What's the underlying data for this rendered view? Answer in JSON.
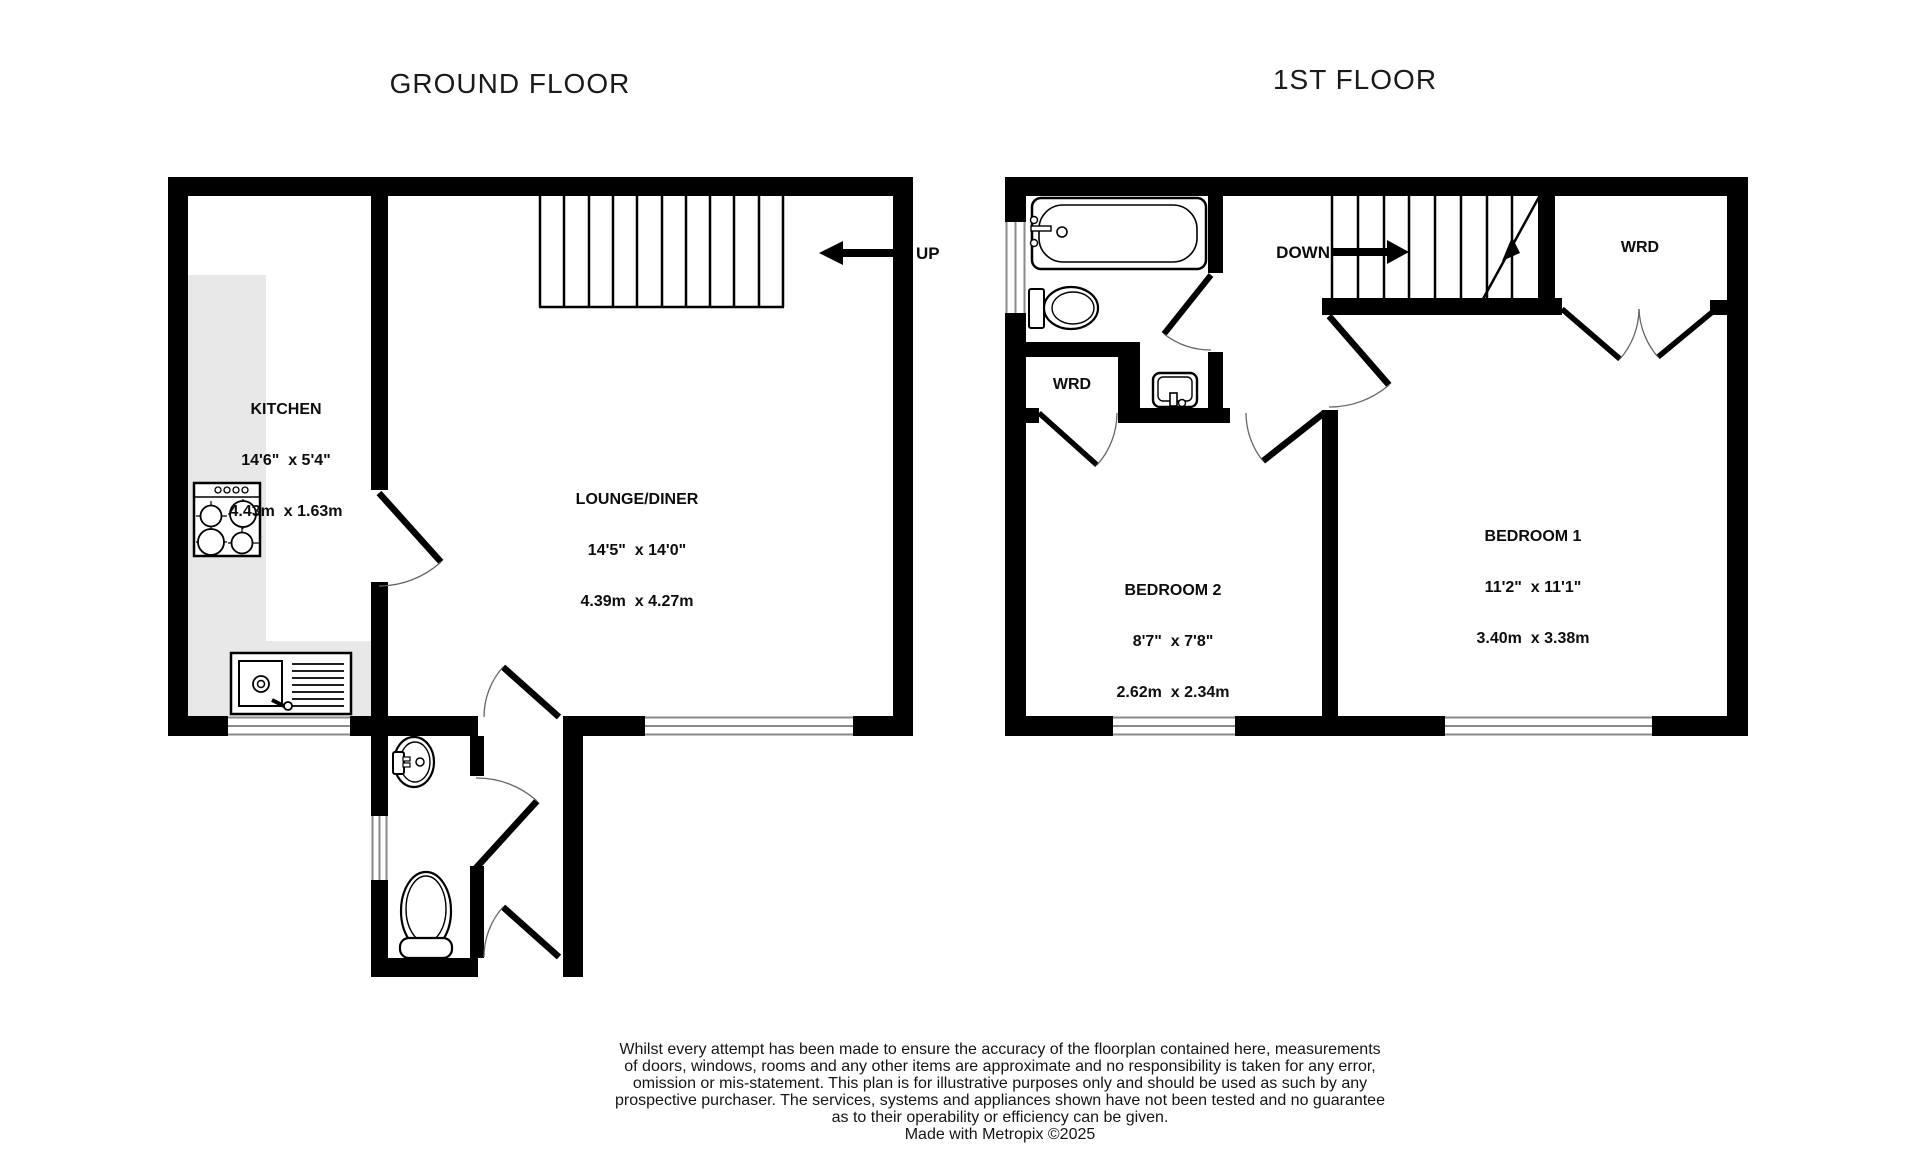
{
  "titles": {
    "ground_floor": "GROUND FLOOR",
    "first_floor": "1ST FLOOR"
  },
  "ground_floor": {
    "kitchen": {
      "label": "KITCHEN",
      "imperial": "14'6\"  x 5'4\"",
      "metric": "4.43m  x 1.63m"
    },
    "lounge": {
      "label": "LOUNGE/DINER",
      "imperial": "14'5\"  x 14'0\"",
      "metric": "4.39m  x 4.27m"
    },
    "stair_label": "UP"
  },
  "first_floor": {
    "bedroom1": {
      "label": "BEDROOM 1",
      "imperial": "11'2\"  x 11'1\"",
      "metric": "3.40m  x 3.38m"
    },
    "bedroom2": {
      "label": "BEDROOM 2",
      "imperial": "8'7\"  x 7'8\"",
      "metric": "2.62m  x 2.34m"
    },
    "wardrobe_left_label": "WRD",
    "wardrobe_right_label": "WRD",
    "stair_label": "DOWN"
  },
  "disclaimer": {
    "lines": [
      "Whilst every attempt has been made to ensure the accuracy of the floorplan contained here, measurements",
      "of doors, windows, rooms and any other items are approximate and no responsibility is taken for any error,",
      "omission or mis-statement. This plan is for illustrative purposes only and should be used as such by any",
      "prospective purchaser. The services, systems and appliances shown have not been tested and no guarantee",
      "as to their operability or efficiency can be given.",
      "Made with Metropix ©2025"
    ]
  },
  "colors": {
    "wall": "#000000",
    "counter": "#e8e8e8",
    "window_line": "#8a8a8a",
    "text": "#111111"
  }
}
